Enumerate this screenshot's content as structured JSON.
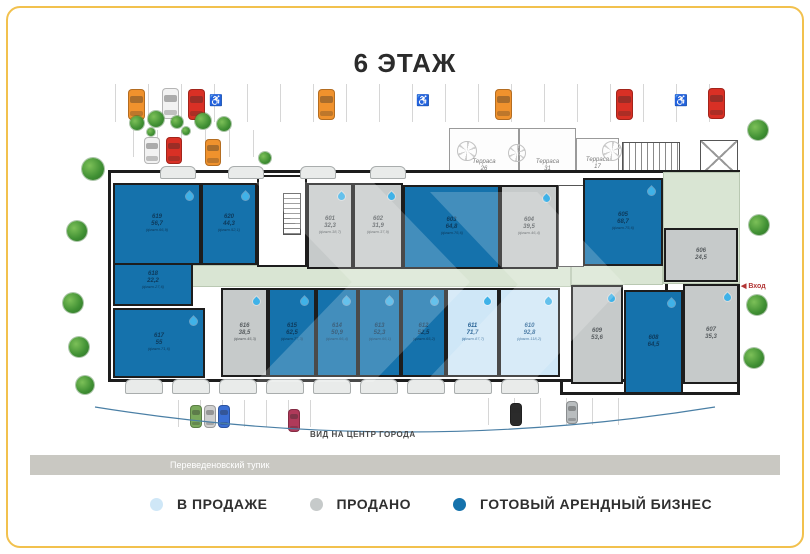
{
  "page": {
    "title": "6 ЭТАЖ"
  },
  "labels": {
    "view": "ВИД НА ЦЕНТР ГОРОДА",
    "street": "Переведеновский тупик",
    "entrance": "◀ Вход"
  },
  "legend": {
    "items": [
      {
        "label": "В ПРОДАЖЕ",
        "status": "sale",
        "color": "#cfe7f7"
      },
      {
        "label": "ПРОДАНО",
        "status": "sold",
        "color": "#c6caca"
      },
      {
        "label": "ГОТОВЫЙ АРЕНДНЫЙ БИЗНЕС",
        "status": "rent",
        "color": "#1572ac"
      }
    ]
  },
  "colors": {
    "rent": "#1572ac",
    "sale": "#cfe7f7",
    "sold": "#c6caca",
    "wall": "#1d1d1d",
    "frame": "#f2c14e"
  },
  "terraces": [
    {
      "label": "Терраса",
      "num": "26",
      "x": 449,
      "y": 128,
      "w": 70,
      "h": 50
    },
    {
      "label": "Терраса",
      "num": "31",
      "x": 519,
      "y": 128,
      "w": 57,
      "h": 50
    },
    {
      "label": "Терраса",
      "num": "17",
      "x": 576,
      "y": 138,
      "w": 43,
      "h": 38
    }
  ],
  "units": [
    {
      "number": "601",
      "area": "32,3",
      "fact": "(факт.38,7)",
      "status": "sold",
      "drop": true,
      "x": 307,
      "y": 183,
      "w": 46,
      "h": 86
    },
    {
      "number": "602",
      "area": "31,9",
      "fact": "(факт.37,9)",
      "status": "sold",
      "drop": true,
      "x": 353,
      "y": 183,
      "w": 50,
      "h": 86
    },
    {
      "number": "603",
      "area": "64,8",
      "fact": "(факт.76,6)",
      "status": "rent",
      "drop": false,
      "x": 403,
      "y": 185,
      "w": 97,
      "h": 84
    },
    {
      "number": "604",
      "area": "39,5",
      "fact": "(факт.46,4)",
      "status": "sold",
      "drop": true,
      "x": 500,
      "y": 185,
      "w": 58,
      "h": 84
    },
    {
      "number": "605",
      "area": "68,7",
      "fact": "(факт.75,6)",
      "status": "rent",
      "drop": true,
      "x": 583,
      "y": 178,
      "w": 80,
      "h": 88
    },
    {
      "number": "606",
      "area": "24,5",
      "fact": "",
      "status": "sold",
      "drop": false,
      "x": 664,
      "y": 228,
      "w": 74,
      "h": 54
    },
    {
      "number": "607",
      "area": "35,3",
      "fact": "",
      "status": "sold",
      "drop": true,
      "x": 683,
      "y": 284,
      "w": 56,
      "h": 100
    },
    {
      "number": "608",
      "area": "64,5",
      "fact": "",
      "status": "rent",
      "drop": true,
      "x": 624,
      "y": 290,
      "w": 59,
      "h": 104
    },
    {
      "number": "609",
      "area": "53,6",
      "fact": "",
      "status": "sold",
      "drop": true,
      "x": 571,
      "y": 285,
      "w": 52,
      "h": 99
    },
    {
      "number": "610",
      "area": "92,8",
      "fact": "(факт.118,2)",
      "status": "sale",
      "drop": true,
      "x": 499,
      "y": 288,
      "w": 61,
      "h": 89
    },
    {
      "number": "611",
      "area": "71,7",
      "fact": "(факт.87,7)",
      "status": "sale",
      "drop": true,
      "x": 446,
      "y": 288,
      "w": 53,
      "h": 89
    },
    {
      "number": "612",
      "area": "52,5",
      "fact": "(факт.65,2)",
      "status": "rent",
      "drop": true,
      "x": 401,
      "y": 288,
      "w": 45,
      "h": 89
    },
    {
      "number": "613",
      "area": "52,3",
      "fact": "(факт.66,1)",
      "status": "rent",
      "drop": true,
      "x": 358,
      "y": 288,
      "w": 43,
      "h": 89
    },
    {
      "number": "614",
      "area": "50,9",
      "fact": "(факт.66,4)",
      "status": "rent",
      "drop": true,
      "x": 316,
      "y": 288,
      "w": 42,
      "h": 89
    },
    {
      "number": "615",
      "area": "62,5",
      "fact": "(факт.77,3)",
      "status": "rent",
      "drop": true,
      "x": 268,
      "y": 288,
      "w": 48,
      "h": 89
    },
    {
      "number": "616",
      "area": "38,5",
      "fact": "(факт.45,3)",
      "status": "sold",
      "drop": true,
      "x": 221,
      "y": 288,
      "w": 47,
      "h": 89
    },
    {
      "number": "617",
      "area": "55",
      "fact": "(факт.71,6)",
      "status": "rent",
      "drop": true,
      "x": 113,
      "y": 308,
      "w": 92,
      "h": 70
    },
    {
      "number": "618",
      "area": "22,2",
      "fact": "(факт.27,6)",
      "status": "rent",
      "drop": false,
      "x": 113,
      "y": 256,
      "w": 80,
      "h": 50
    },
    {
      "number": "619",
      "area": "56,7",
      "fact": "(факт.66,9)",
      "status": "rent",
      "drop": true,
      "x": 113,
      "y": 183,
      "w": 88,
      "h": 82
    },
    {
      "number": "620",
      "area": "44,3",
      "fact": "(факт.52,1)",
      "status": "rent",
      "drop": true,
      "x": 201,
      "y": 183,
      "w": 56,
      "h": 82
    }
  ],
  "plan": {
    "buildings": [
      {
        "x": 560,
        "y": 170,
        "w": 180,
        "h": 225
      },
      {
        "x": 108,
        "y": 170,
        "w": 560,
        "h": 212
      }
    ],
    "greens": [
      {
        "x": 113,
        "y": 265,
        "w": 458,
        "h": 22
      },
      {
        "x": 571,
        "y": 265,
        "w": 92,
        "h": 20
      },
      {
        "x": 663,
        "y": 172,
        "w": 77,
        "h": 112
      }
    ],
    "services": [
      {
        "type": "room",
        "x": 257,
        "y": 175,
        "w": 50,
        "h": 92
      },
      {
        "type": "elev",
        "x": 558,
        "y": 185,
        "w": 26,
        "h": 82
      }
    ],
    "stairs_top": {
      "x": 622,
      "y": 142,
      "w": 58,
      "h": 33
    },
    "xbox_top": {
      "x": 700,
      "y": 140,
      "w": 38,
      "h": 36
    },
    "inner_stairs": {
      "x": 283,
      "y": 193,
      "w": 18,
      "h": 42
    },
    "fans": [
      {
        "x": 466,
        "y": 150,
        "r": 9
      },
      {
        "x": 516,
        "y": 152,
        "r": 8
      },
      {
        "x": 611,
        "y": 150,
        "r": 9
      }
    ],
    "balconies_bottom": {
      "y": 379,
      "w": 38,
      "h": 15,
      "xs": [
        125,
        172,
        219,
        266,
        313,
        360,
        407,
        454,
        501
      ]
    },
    "balconies_top": {
      "y": 166,
      "w": 36,
      "h": 13,
      "xs": [
        160,
        228,
        300,
        370
      ]
    },
    "watermarks": [
      {
        "x": 255,
        "y": 182,
        "w": 215,
        "h": 200
      },
      {
        "x": 430,
        "y": 192,
        "w": 195,
        "h": 185
      }
    ]
  },
  "environment": {
    "parking_groups": [
      {
        "x0": 115,
        "count": 19,
        "gap": 33,
        "y": 84,
        "h": 38
      },
      {
        "x0": 133,
        "count": 6,
        "gap": 24,
        "y": 130,
        "h": 27
      },
      {
        "x0": 178,
        "count": 7,
        "gap": 22,
        "y": 400,
        "h": 27
      },
      {
        "x0": 488,
        "count": 6,
        "gap": 26,
        "y": 398,
        "h": 27
      }
    ],
    "handicap": [
      {
        "x": 209,
        "y": 94
      },
      {
        "x": 416,
        "y": 94
      },
      {
        "x": 674,
        "y": 94
      }
    ],
    "cars": [
      {
        "x": 128,
        "y": 89,
        "w": 17,
        "h": 31,
        "color": "#f0922d"
      },
      {
        "x": 162,
        "y": 88,
        "w": 17,
        "h": 31,
        "color": "#f2f2f2"
      },
      {
        "x": 188,
        "y": 89,
        "w": 17,
        "h": 31,
        "color": "#d93025"
      },
      {
        "x": 318,
        "y": 89,
        "w": 17,
        "h": 31,
        "color": "#f0922d"
      },
      {
        "x": 495,
        "y": 89,
        "w": 17,
        "h": 31,
        "color": "#f0922d"
      },
      {
        "x": 616,
        "y": 89,
        "w": 17,
        "h": 31,
        "color": "#d93025"
      },
      {
        "x": 708,
        "y": 88,
        "w": 17,
        "h": 31,
        "color": "#d93025"
      },
      {
        "x": 144,
        "y": 137,
        "w": 16,
        "h": 27,
        "color": "#f2f2f2"
      },
      {
        "x": 166,
        "y": 137,
        "w": 16,
        "h": 27,
        "color": "#d93025"
      },
      {
        "x": 205,
        "y": 139,
        "w": 16,
        "h": 27,
        "color": "#f0922d"
      },
      {
        "x": 190,
        "y": 405,
        "w": 12,
        "h": 23,
        "color": "#7aa95c"
      },
      {
        "x": 204,
        "y": 405,
        "w": 12,
        "h": 23,
        "color": "#cfcfcf"
      },
      {
        "x": 218,
        "y": 405,
        "w": 12,
        "h": 23,
        "color": "#3b6fd4"
      },
      {
        "x": 288,
        "y": 409,
        "w": 12,
        "h": 23,
        "color": "#b03a5a"
      },
      {
        "x": 510,
        "y": 403,
        "w": 12,
        "h": 23,
        "color": "#2b2b2b"
      },
      {
        "x": 566,
        "y": 401,
        "w": 12,
        "h": 23,
        "color": "#b9bdbf"
      }
    ],
    "trees": [
      {
        "x": 82,
        "y": 158,
        "r": 11
      },
      {
        "x": 67,
        "y": 221,
        "r": 10
      },
      {
        "x": 63,
        "y": 293,
        "r": 10
      },
      {
        "x": 69,
        "y": 337,
        "r": 10
      },
      {
        "x": 76,
        "y": 376,
        "r": 9
      },
      {
        "x": 748,
        "y": 120,
        "r": 10
      },
      {
        "x": 749,
        "y": 215,
        "r": 10
      },
      {
        "x": 747,
        "y": 295,
        "r": 10
      },
      {
        "x": 744,
        "y": 348,
        "r": 10
      }
    ],
    "bushes": [
      {
        "x": 130,
        "y": 116,
        "r": 7
      },
      {
        "x": 148,
        "y": 111,
        "r": 8
      },
      {
        "x": 171,
        "y": 116,
        "r": 6
      },
      {
        "x": 195,
        "y": 113,
        "r": 8
      },
      {
        "x": 217,
        "y": 117,
        "r": 7
      },
      {
        "x": 259,
        "y": 152,
        "r": 6
      },
      {
        "x": 147,
        "y": 128,
        "r": 4
      },
      {
        "x": 182,
        "y": 127,
        "r": 4
      }
    ]
  }
}
